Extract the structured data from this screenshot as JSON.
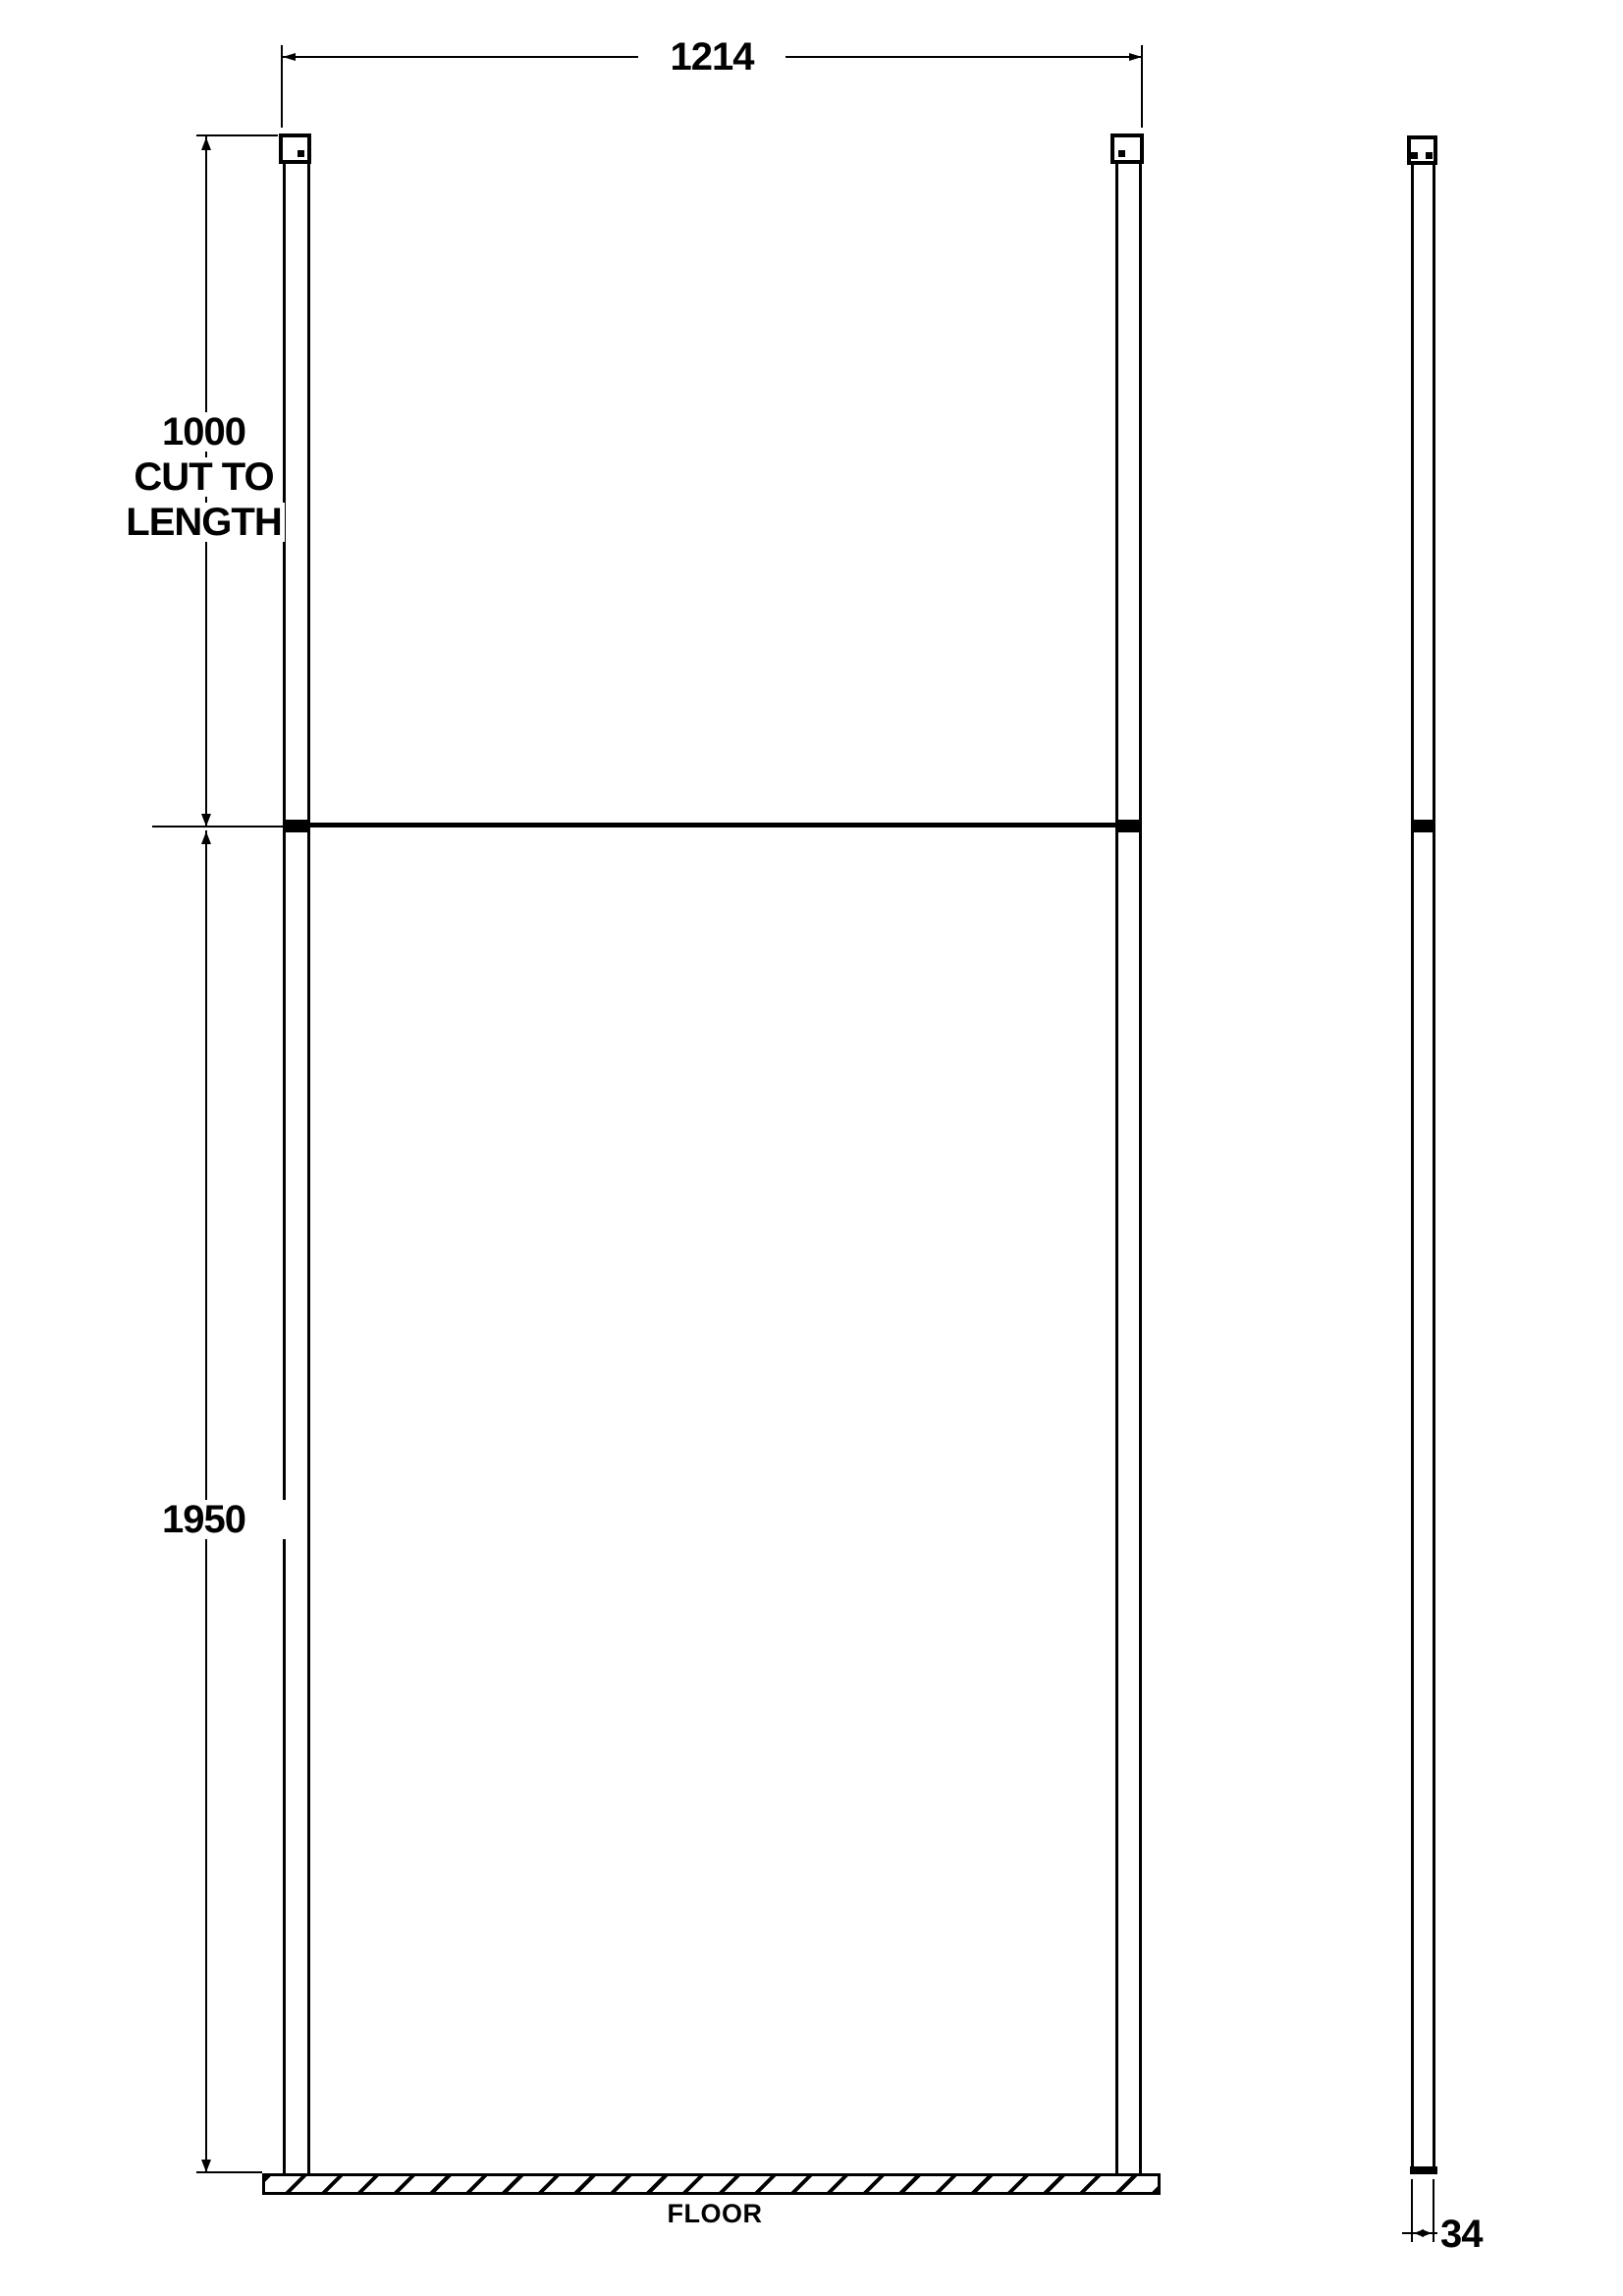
{
  "labels": {
    "width": "1214",
    "cut_length": [
      "1000",
      "CUT TO",
      "LENGTH"
    ],
    "height": "1950",
    "floor": "FLOOR",
    "thickness": "34"
  },
  "measurements": {
    "panel_width_mm": 1214,
    "ceiling_post_mm": 1000,
    "ceiling_post_note": "CUT TO LENGTH",
    "panel_height_mm": 1950,
    "frame_thickness_mm": 34
  },
  "colors": {
    "line": "#000000",
    "background": "#ffffff"
  }
}
